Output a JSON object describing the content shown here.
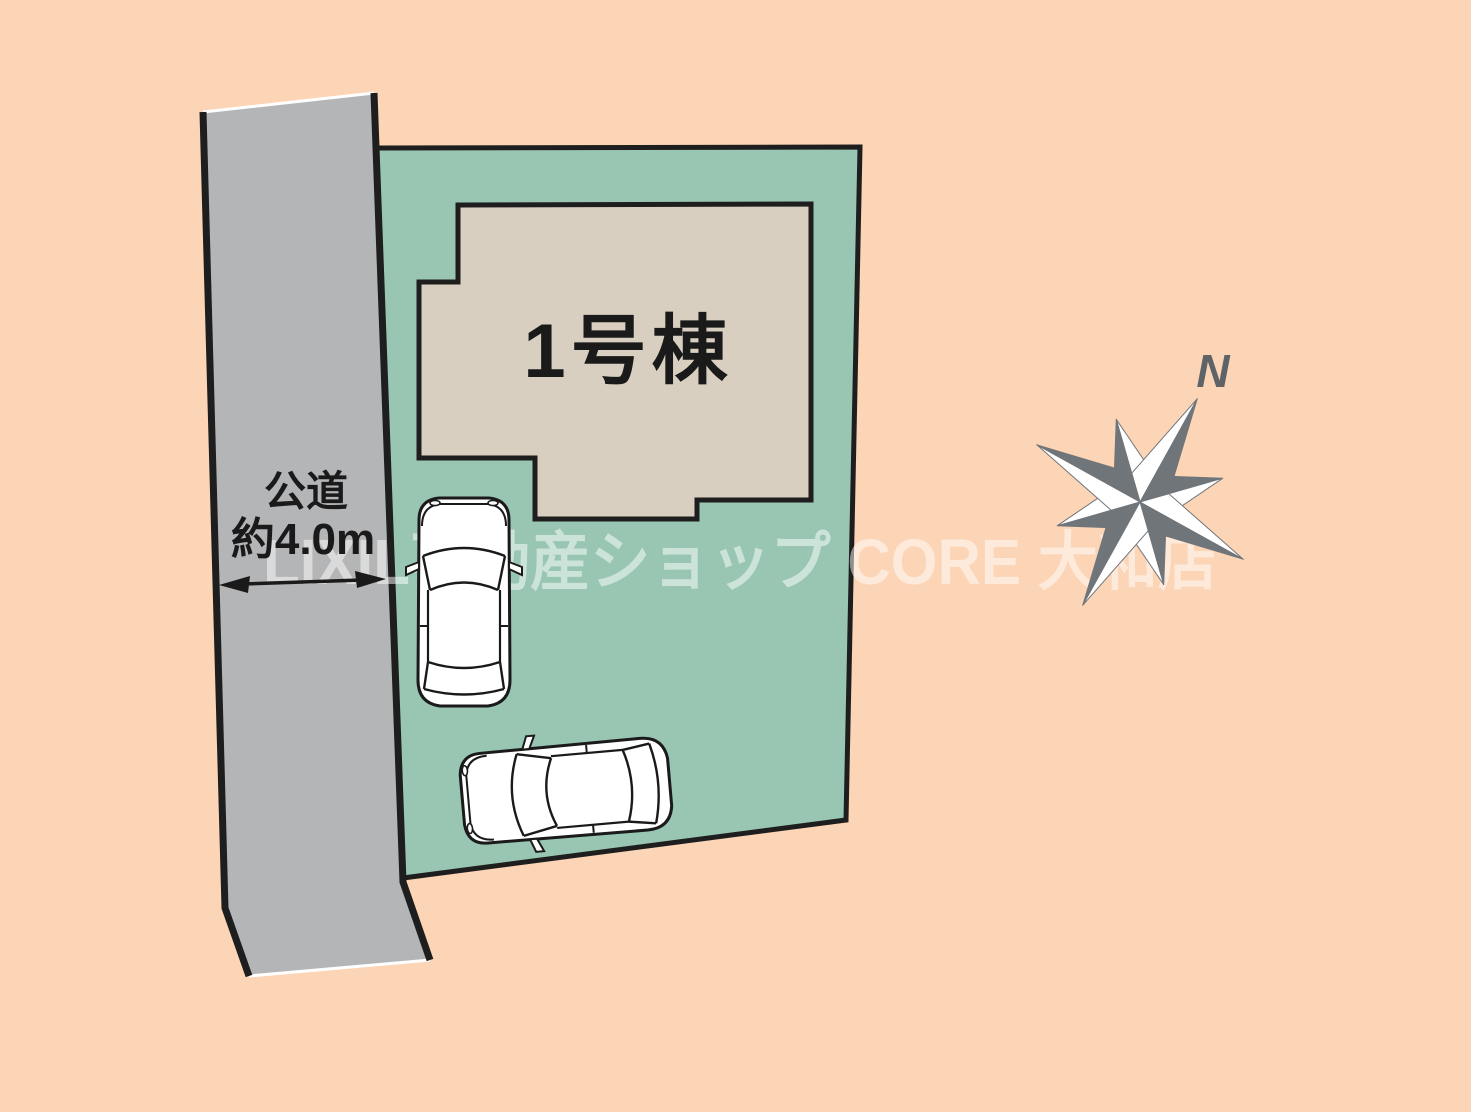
{
  "canvas": {
    "background_color": "#FCD4B6"
  },
  "road": {
    "name": "公道",
    "width": "約4.0m",
    "fill_color": "#B4B5B7",
    "edge_color": "#1E1E1E"
  },
  "plot": {
    "fill_color": "#99C6B2",
    "outline_color": "#1E1E1E"
  },
  "building": {
    "label": "1号棟",
    "fill_color": "#D9CFC0",
    "outline_color": "#1E1E1E"
  },
  "compass": {
    "north_label": "N",
    "dark_color": "#70757A",
    "light_color": "#FFFFFF"
  },
  "watermark": {
    "text": "LIXIL不動産ショップ CORE 大和店",
    "color": "rgba(255,255,255,0.5)"
  },
  "cars": {
    "count": 2,
    "body_color": "#FFFFFF",
    "outline_color": "#1A1A1A"
  }
}
